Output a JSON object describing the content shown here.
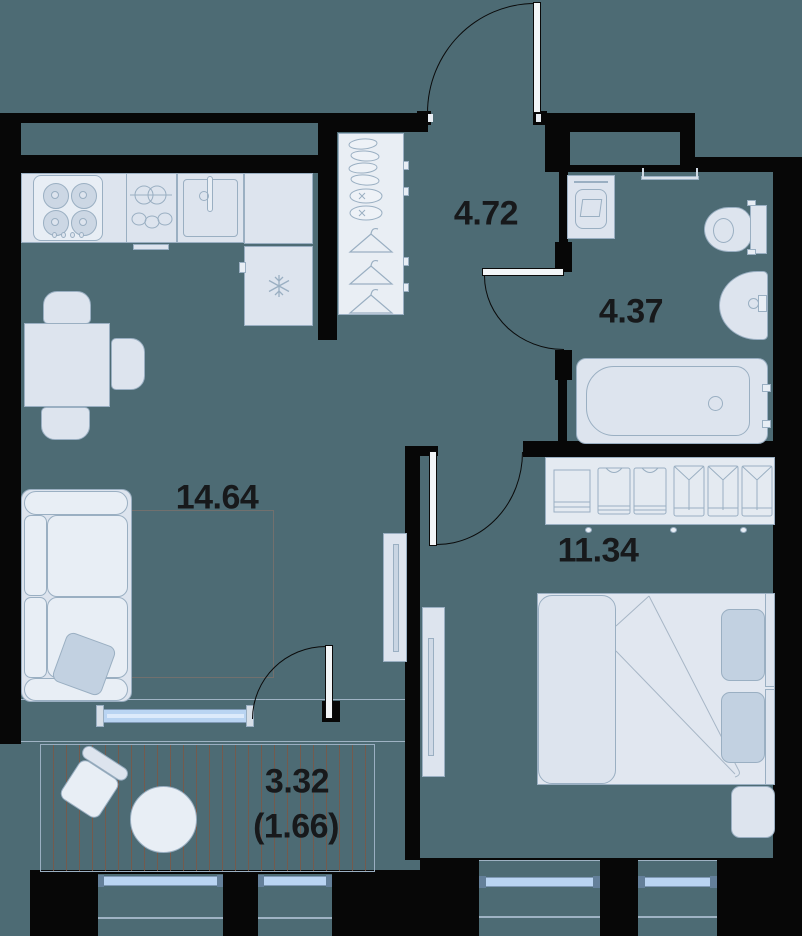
{
  "title": "apartment-floor-plan",
  "rooms": {
    "living": {
      "name": "kitchen-living-room",
      "area": "14.64"
    },
    "hallway": {
      "name": "hallway",
      "area": "4.72"
    },
    "bathroom": {
      "name": "bathroom",
      "area": "4.37"
    },
    "bedroom": {
      "name": "bedroom",
      "area": "11.34"
    },
    "balcony": {
      "name": "balcony",
      "area_total": "3.32",
      "area_reduced": "(1.66)"
    }
  },
  "colors": {
    "floor_teal": "#4d6b74",
    "wall_black": "#070707",
    "furniture_fill": "#dde4ee",
    "furniture_stroke": "#9aafc2",
    "textile_accent": "#c2d1e1",
    "window_glass": "#b9d4f2",
    "deck_stripe": "#7a5848",
    "label_text": "#17191b"
  },
  "icons": {
    "kitchen": [
      "stove-burners-icon",
      "pots-icon",
      "sink-faucet-icon",
      "snowflake-icon"
    ],
    "hallway": [
      "shoes-icon",
      "hanger-icon"
    ],
    "bedroom": [
      "shelf-icon",
      "tshirt-icon",
      "shirt-icon",
      "bed-icon",
      "tv-icon"
    ],
    "bathroom": [
      "washing-machine-icon",
      "towel-rail-icon",
      "toilet-icon",
      "basin-icon",
      "bathtub-icon"
    ],
    "living": [
      "sofa-icon",
      "dining-table-icon",
      "chair-icon",
      "tv-icon"
    ],
    "balcony": [
      "round-table-icon",
      "chair-icon"
    ],
    "doors": "door-swing-arc"
  }
}
